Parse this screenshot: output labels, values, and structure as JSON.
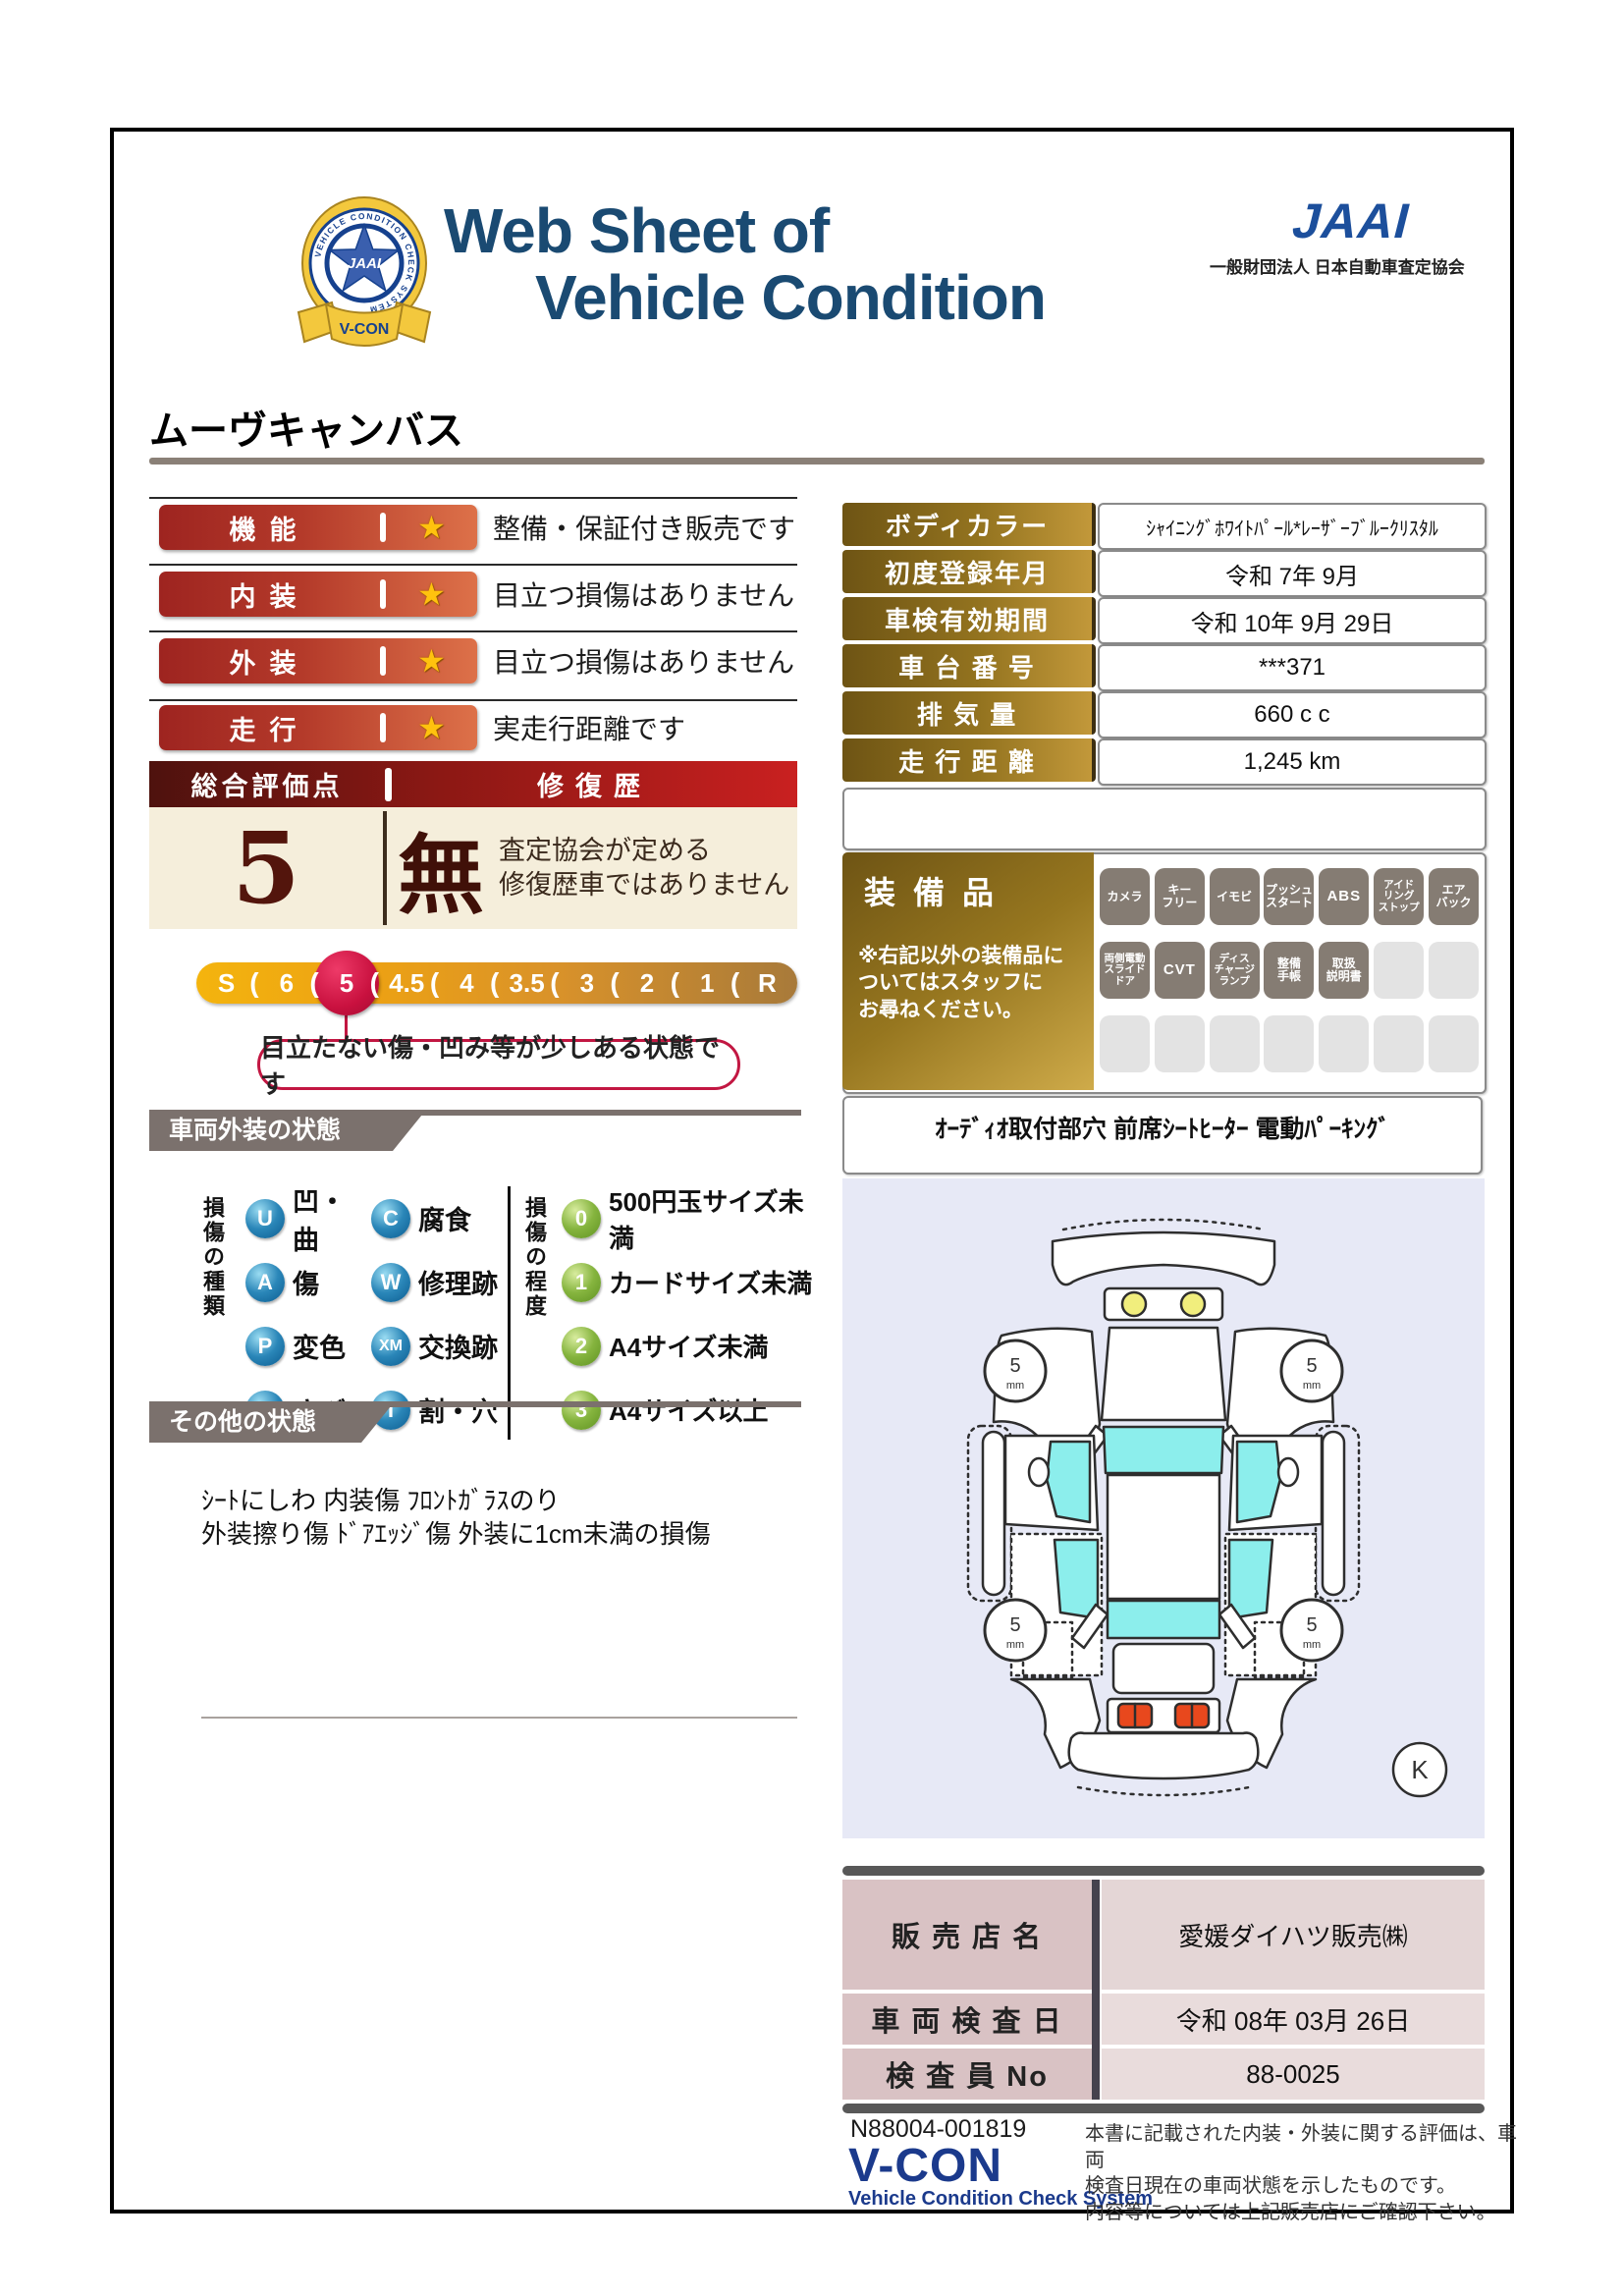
{
  "header": {
    "title_line1": "Web Sheet of",
    "title_line2": "Vehicle Condition",
    "jaai_logo_text": "JAAI",
    "jaai_subtitle": "一般財団法人 日本自動車査定協会",
    "badge": {
      "ring_text": "VEHICLE CONDITION CHECK SYSTEM",
      "star_text": "JAAI",
      "ribbon_text": "V-CON"
    }
  },
  "vehicle_name": "ムーヴキャンバス",
  "ratings": {
    "star": "★",
    "rows": [
      {
        "label": "機能",
        "desc": "整備・保証付き販売です"
      },
      {
        "label": "内装",
        "desc": "目立つ損傷はありません"
      },
      {
        "label": "外装",
        "desc": "目立つ損傷はありません"
      },
      {
        "label": "走行",
        "desc": "実走行距離です"
      }
    ]
  },
  "overall": {
    "header_left": "総合評価点",
    "header_right": "修復歴",
    "score": "5",
    "repair_flag": "無",
    "repair_desc": "査定協会が定める\n修復歴車ではありません"
  },
  "scale": {
    "separator": "(",
    "items": [
      "S",
      "6",
      "5",
      "4.5",
      "4",
      "3.5",
      "3",
      "2",
      "1",
      "R"
    ],
    "selected_value": "5",
    "callout": "目立たない傷・凹み等が少しある状態です"
  },
  "info_table": {
    "rows": [
      {
        "label": "ボディカラー",
        "value": "ｼｬｲﾆﾝｸﾞﾎﾜｲﾄﾊﾟｰﾙ*ﾚｰｻﾞｰﾌﾞﾙｰｸﾘｽﾀﾙ"
      },
      {
        "label": "初度登録年月",
        "value": "令和 7年 9月"
      },
      {
        "label": "車検有効期間",
        "value": "令和 10年 9月 29日"
      },
      {
        "label": "車 台 番 号",
        "value": "***371"
      },
      {
        "label": "排 気 量",
        "value": "660 c c"
      },
      {
        "label": "走 行 距 離",
        "value": "1,245 km"
      }
    ]
  },
  "equipment": {
    "title": "装備品",
    "note": "※右記以外の装備品に\nついてはスタッフに\nお尋ねください。",
    "row1": [
      "カメラ",
      "キー\nフリー",
      "イモビ",
      "プッシュ\nスタート",
      "ABS",
      "アイド\nリング\nストップ",
      "エア\nバック"
    ],
    "row2": [
      "両側電動\nスライド\nドア",
      "CVT",
      "ディス\nチャージ\nランプ",
      "整備\n手帳",
      "取扱\n説明書"
    ],
    "extra": "ｵｰﾃﾞｨｵ取付部穴 前席ｼｰﾄﾋｰﾀｰ 電動ﾊﾟｰｷﾝｸﾞ"
  },
  "exterior": {
    "header": "車両外装の状態",
    "type_label": "損傷の種類",
    "types": [
      {
        "code": "U",
        "label": "凹・曲"
      },
      {
        "code": "C",
        "label": "腐食"
      },
      {
        "code": "A",
        "label": "傷"
      },
      {
        "code": "W",
        "label": "修理跡"
      },
      {
        "code": "P",
        "label": "変色"
      },
      {
        "code": "XM",
        "label": "交換跡"
      },
      {
        "code": "S",
        "label": "さび"
      },
      {
        "code": "T",
        "label": "割・穴"
      }
    ],
    "degree_label": "損傷の程度",
    "degrees": [
      {
        "code": "0",
        "label": "500円玉サイズ未満"
      },
      {
        "code": "1",
        "label": "カードサイズ未満"
      },
      {
        "code": "2",
        "label": "A4サイズ未満"
      },
      {
        "code": "3",
        "label": "A4サイズ以上"
      }
    ]
  },
  "other": {
    "header": "その他の状態",
    "text": "ｼｰﾄにしわ 内装傷 ﾌﾛﾝﾄｶﾞﾗｽのり\n外装擦り傷 ﾄﾞｱｴｯｼﾞ傷 外装に1cm未満の損傷"
  },
  "diagram": {
    "wheel_value": "5",
    "wheel_unit": "mm",
    "corner_mark": "K"
  },
  "dealer": {
    "rows": [
      {
        "label": "販 売 店 名",
        "value": "愛媛ダイハツ販売㈱"
      },
      {
        "label": "車 両 検 査 日",
        "value": "令和 08年 03月 26日"
      },
      {
        "label": "検 査 員 No",
        "value": "88-0025"
      }
    ]
  },
  "footer": {
    "code": "N88004-001819",
    "vcon": "V-CON",
    "vcon_sub": "Vehicle Condition Check System",
    "disclaimer": "本書に記載された内装・外装に関する評価は、車両\n検査日現在の車両状態を示したものです。\n内容等については上記販売店にご確認下さい。"
  },
  "colors": {
    "title_blue": "#1a4a72",
    "jaai_blue": "#1c4f9c",
    "rating_red": "#9e2420",
    "rating_orange": "#dd7149",
    "star_gold": "#ffc20e",
    "gold_dark": "#6e5414",
    "gold_light": "#c2983a",
    "score_cream": "#f5eedb",
    "maroon": "#53150c",
    "scale_selected_red": "#c9113f",
    "section_gray": "#7b716d",
    "badge_gray": "#857c73",
    "badge_empty": "#e3e3e3",
    "dealer_label_pink": "#d9c2c4",
    "dealer_value_pink": "#e9dcdc",
    "diagram_bg": "#e7e9f6",
    "glass_cyan": "#8ceeec"
  }
}
